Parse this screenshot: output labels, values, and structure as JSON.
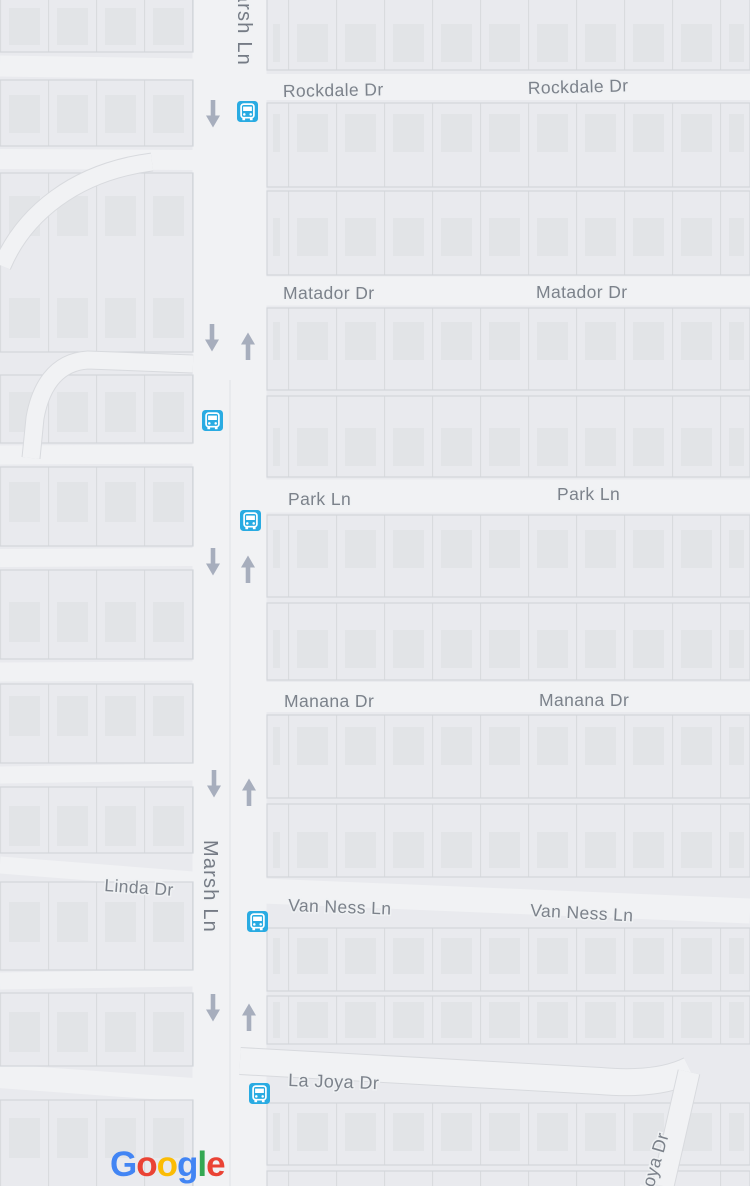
{
  "map": {
    "type": "street-map",
    "streets": {
      "marsh": "Marsh Ln",
      "rockdale": "Rockdale Dr",
      "matador": "Matador Dr",
      "park": "Park Ln",
      "manana": "Manana Dr",
      "van_ness": "Van Ness Ln",
      "la_joya": "La Joya Dr",
      "joya_partial": "Joya Dr",
      "linda": "Linda Dr"
    },
    "icons": {
      "bus_stop": {
        "name": "bus-stop-icon",
        "glyph": "bus",
        "count": 5,
        "color": "#29ABE2"
      },
      "one_way_down": {
        "name": "one-way-down-icon",
        "glyph": "↓",
        "count": 5,
        "color": "#A7AEBD"
      },
      "one_way_up": {
        "name": "one-way-up-icon",
        "glyph": "↑",
        "count": 4,
        "color": "#A7AEBD"
      }
    },
    "palette": {
      "background_block": "#E9EAEE",
      "road": "#F1F2F4",
      "building": "#E2E4E7",
      "parcel_line": "#D9DBDE",
      "block_edge": "#D3D6DB",
      "label_gray": "#7C828B"
    }
  },
  "google_logo": {
    "text": "Google",
    "letters": [
      "G",
      "o",
      "o",
      "g",
      "l",
      "e"
    ],
    "colors": [
      "#4285F4",
      "#EA4335",
      "#FBBC05",
      "#4285F4",
      "#34A853",
      "#EA4335"
    ]
  }
}
